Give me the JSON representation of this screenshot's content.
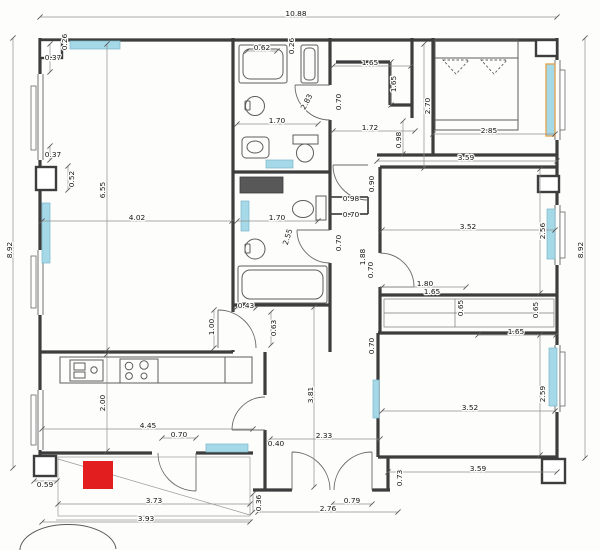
{
  "meta": {
    "document_type": "architectural floor plan (scanned apartment blueprint)",
    "canvas": {
      "w": 600,
      "h": 550
    }
  },
  "colors": {
    "radiator_fill": "#a6d9e8",
    "radiator_accent_border": "#e0a24a",
    "marker_fill": "#e31e1f",
    "wall": "#3d3d3d",
    "background": "#fdfdfc",
    "dim_text": "#161616"
  },
  "overall_dims": {
    "total_width_m": "10.88",
    "left_height_m": "8.92",
    "right_height_m": "8.92"
  },
  "dim_labels": [
    {
      "t": "10.88",
      "x": 296,
      "y": 14,
      "r": 0
    },
    {
      "t": "8.92",
      "x": 10,
      "y": 250,
      "r": -90
    },
    {
      "t": "8.92",
      "x": 581,
      "y": 250,
      "r": -90
    },
    {
      "t": "0.26",
      "x": 65,
      "y": 42,
      "r": -90
    },
    {
      "t": "0.37",
      "x": 53,
      "y": 58,
      "r": 0
    },
    {
      "t": "0.37",
      "x": 53,
      "y": 155,
      "r": 0
    },
    {
      "t": "0.52",
      "x": 72,
      "y": 179,
      "r": -90
    },
    {
      "t": "6.55",
      "x": 103,
      "y": 190,
      "r": -90
    },
    {
      "t": "4.02",
      "x": 137,
      "y": 218,
      "r": 0
    },
    {
      "t": "2.00",
      "x": 103,
      "y": 403,
      "r": -90
    },
    {
      "t": "4.45",
      "x": 148,
      "y": 426,
      "r": 0
    },
    {
      "t": "0.70",
      "x": 179,
      "y": 435,
      "r": 0
    },
    {
      "t": "0.40",
      "x": 276,
      "y": 444,
      "r": 0
    },
    {
      "t": "0.59",
      "x": 45,
      "y": 485,
      "r": 0
    },
    {
      "t": "3.73",
      "x": 154,
      "y": 501,
      "r": 0
    },
    {
      "t": "3.93",
      "x": 146,
      "y": 519,
      "r": 0
    },
    {
      "t": "0.36",
      "x": 259,
      "y": 503,
      "r": -90
    },
    {
      "t": "2.76",
      "x": 328,
      "y": 509,
      "r": 0
    },
    {
      "t": "0.79",
      "x": 352,
      "y": 501,
      "r": 0
    },
    {
      "t": "0.73",
      "x": 400,
      "y": 478,
      "r": -90
    },
    {
      "t": "3.59",
      "x": 478,
      "y": 469,
      "r": 0
    },
    {
      "t": "0.62",
      "x": 262,
      "y": 48,
      "r": 0
    },
    {
      "t": "0.26",
      "x": 292,
      "y": 46,
      "r": -90
    },
    {
      "t": "2.83",
      "x": 307,
      "y": 102,
      "r": -62
    },
    {
      "t": "1.70",
      "x": 277,
      "y": 121,
      "r": 0
    },
    {
      "t": "0.70",
      "x": 339,
      "y": 102,
      "r": -90
    },
    {
      "t": "1.65",
      "x": 370,
      "y": 63,
      "r": 0
    },
    {
      "t": "1.65",
      "x": 394,
      "y": 84,
      "r": -90
    },
    {
      "t": "1.72",
      "x": 370,
      "y": 128,
      "r": 0
    },
    {
      "t": "0.98",
      "x": 399,
      "y": 140,
      "r": -90
    },
    {
      "t": "2.70",
      "x": 428,
      "y": 106,
      "r": -90
    },
    {
      "t": "2.85",
      "x": 489,
      "y": 131,
      "r": 0
    },
    {
      "t": "3.59",
      "x": 466,
      "y": 158,
      "r": 0
    },
    {
      "t": "0.90",
      "x": 372,
      "y": 184,
      "r": -90
    },
    {
      "t": "0.98",
      "x": 351,
      "y": 199,
      "r": 0
    },
    {
      "t": "0.70",
      "x": 351,
      "y": 215,
      "r": 0
    },
    {
      "t": "1.70",
      "x": 277,
      "y": 218,
      "r": 0
    },
    {
      "t": "2.55",
      "x": 288,
      "y": 237,
      "r": -73
    },
    {
      "t": "0.70",
      "x": 339,
      "y": 243,
      "r": -90
    },
    {
      "t": "1.88",
      "x": 363,
      "y": 257,
      "r": -90
    },
    {
      "t": "0.70",
      "x": 371,
      "y": 270,
      "r": -90
    },
    {
      "t": "3.52",
      "x": 468,
      "y": 227,
      "r": 0
    },
    {
      "t": "2.56",
      "x": 543,
      "y": 231,
      "r": -90
    },
    {
      "t": "1.80",
      "x": 425,
      "y": 284,
      "r": 0
    },
    {
      "t": "1.65",
      "x": 432,
      "y": 292,
      "r": 0
    },
    {
      "t": "0.65",
      "x": 461,
      "y": 308,
      "r": -90
    },
    {
      "t": "0.65",
      "x": 536,
      "y": 310,
      "r": -90
    },
    {
      "t": "1.65",
      "x": 516,
      "y": 332,
      "r": 0
    },
    {
      "t": "0.43",
      "x": 246,
      "y": 306,
      "r": 0
    },
    {
      "t": "0.63",
      "x": 274,
      "y": 328,
      "r": -90
    },
    {
      "t": "1.00",
      "x": 212,
      "y": 327,
      "r": -90
    },
    {
      "t": "0.70",
      "x": 372,
      "y": 346,
      "r": -90
    },
    {
      "t": "3.52",
      "x": 470,
      "y": 408,
      "r": 0
    },
    {
      "t": "2.59",
      "x": 543,
      "y": 394,
      "r": -90
    },
    {
      "t": "3.81",
      "x": 311,
      "y": 395,
      "r": -90
    },
    {
      "t": "2.33",
      "x": 324,
      "y": 436,
      "r": 0
    }
  ],
  "dim_lines": [
    [
      40,
      17,
      557,
      17
    ],
    [
      13,
      38,
      13,
      468
    ],
    [
      585,
      38,
      585,
      458
    ],
    [
      107,
      44,
      107,
      350
    ],
    [
      42,
      221,
      232,
      221
    ],
    [
      107,
      354,
      107,
      451
    ],
    [
      42,
      429,
      253,
      429
    ],
    [
      162,
      438,
      196,
      438
    ],
    [
      58,
      504,
      250,
      504
    ],
    [
      42,
      522,
      250,
      522
    ],
    [
      258,
      512,
      398,
      512
    ],
    [
      332,
      504,
      372,
      504
    ],
    [
      388,
      472,
      557,
      472
    ],
    [
      270,
      439,
      380,
      439
    ],
    [
      314,
      307,
      314,
      487
    ],
    [
      247,
      51,
      277,
      51
    ],
    [
      237,
      124,
      318,
      124
    ],
    [
      237,
      221,
      318,
      221
    ],
    [
      333,
      66,
      411,
      66
    ],
    [
      333,
      131,
      415,
      131
    ],
    [
      424,
      44,
      424,
      168
    ],
    [
      433,
      134,
      555,
      134
    ],
    [
      377,
      161,
      557,
      161
    ],
    [
      382,
      230,
      555,
      230
    ],
    [
      540,
      169,
      540,
      293
    ],
    [
      382,
      287,
      466,
      287
    ],
    [
      478,
      335,
      556,
      335
    ],
    [
      382,
      411,
      555,
      411
    ],
    [
      540,
      335,
      540,
      455
    ],
    [
      34,
      481,
      57,
      481
    ],
    [
      391,
      62,
      391,
      105
    ],
    [
      403,
      121,
      403,
      154
    ],
    [
      236,
      308,
      256,
      308
    ],
    [
      271,
      312,
      271,
      345
    ],
    [
      214,
      310,
      214,
      348
    ],
    [
      68,
      166,
      68,
      190
    ],
    [
      50,
      44,
      50,
      72
    ],
    [
      50,
      146,
      50,
      160
    ],
    [
      253,
      494,
      253,
      512
    ]
  ],
  "radiators": [
    {
      "x": 70,
      "y": 41,
      "w": 50,
      "h": 8,
      "accent": false
    },
    {
      "x": 266,
      "y": 160,
      "w": 27,
      "h": 8,
      "accent": false
    },
    {
      "x": 241,
      "y": 201,
      "w": 8,
      "h": 30,
      "accent": false
    },
    {
      "x": 42,
      "y": 203,
      "w": 8,
      "h": 60,
      "accent": false
    },
    {
      "x": 546,
      "y": 64,
      "w": 9,
      "h": 72,
      "accent": true
    },
    {
      "x": 547,
      "y": 209,
      "w": 8,
      "h": 50,
      "accent": false
    },
    {
      "x": 549,
      "y": 348,
      "w": 8,
      "h": 58,
      "accent": false
    },
    {
      "x": 373,
      "y": 380,
      "w": 6,
      "h": 38,
      "accent": false
    },
    {
      "x": 206,
      "y": 444,
      "w": 42,
      "h": 8,
      "accent": false
    }
  ],
  "marker": {
    "x": 83,
    "y": 461,
    "w": 30,
    "h": 28
  }
}
